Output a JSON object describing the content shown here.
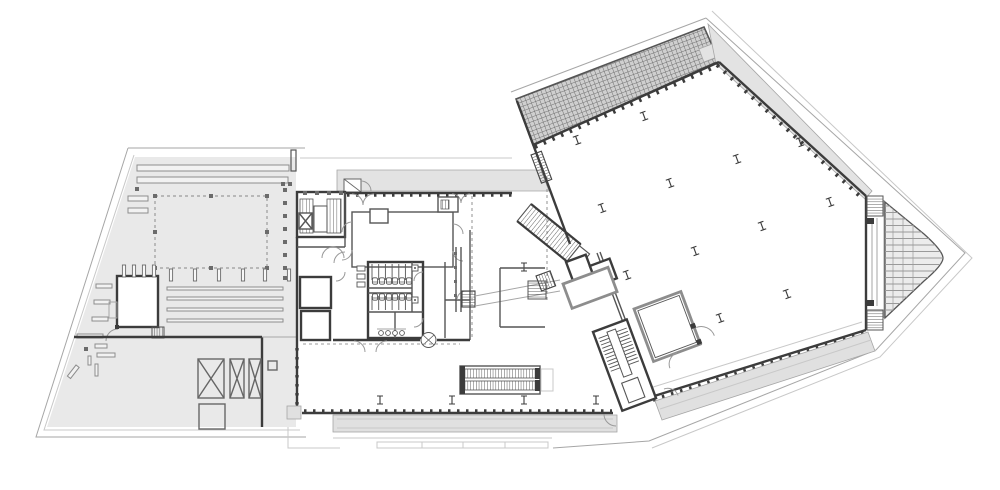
{
  "document": {
    "type": "architectural floor plan, roof / upper level, monochrome line drawing",
    "visible_text": ""
  },
  "palette": {
    "bg": "#ffffff",
    "site": "#e9e9e9",
    "terrace": "#e3e3e3",
    "band": "#e0e0e0",
    "gridband": "#cfcfcf",
    "gridline": "#6e6e6e",
    "deck": "#ececec",
    "deckline": "#9a9a9a",
    "wall": "#3c3c3c",
    "wallmid": "#6b6b6b",
    "wallsoft": "#8d8d8d",
    "line": "#a6a6a6",
    "faint": "#c8c8c8",
    "hatch": "#4a4a4a",
    "dash": "#9b9b9b",
    "barfill": "#f2f2f2"
  },
  "left_wing": {
    "label": "west service terrace (trapezoid, grey)",
    "parking_ticks": [
      [
        171,
        275
      ],
      [
        195,
        275
      ],
      [
        219,
        275
      ],
      [
        243,
        275
      ],
      [
        265,
        275
      ],
      [
        289,
        275
      ]
    ],
    "edge_squares": [
      [
        285,
        190
      ],
      [
        285,
        203
      ],
      [
        285,
        216
      ],
      [
        285,
        229
      ],
      [
        285,
        242
      ],
      [
        285,
        255
      ],
      [
        285,
        268
      ],
      [
        285,
        278
      ],
      [
        137,
        189
      ],
      [
        283,
        184
      ],
      [
        290,
        184
      ]
    ],
    "dashed_nodes": [
      [
        155,
        196
      ],
      [
        211,
        196
      ],
      [
        267,
        196
      ],
      [
        155,
        232
      ],
      [
        267,
        232
      ],
      [
        155,
        268
      ],
      [
        211,
        268
      ],
      [
        267,
        268
      ]
    ],
    "room_posts": [
      [
        124,
        271
      ],
      [
        134,
        271
      ],
      [
        144,
        271
      ],
      [
        154,
        271
      ]
    ],
    "shaft_boxes_with_x": 3
  },
  "middle_building": {
    "label": "central entrance block with cores, WCs and escalator",
    "stair_posts": [
      [
        305,
        193
      ],
      [
        317,
        193
      ],
      [
        329,
        193
      ],
      [
        341,
        193
      ]
    ],
    "column_markers": [
      [
        380,
        400
      ],
      [
        452,
        400
      ],
      [
        524,
        400
      ],
      [
        596,
        400
      ],
      [
        524,
        267
      ]
    ],
    "wc": {
      "fixtures_top": [
        [
          375,
          281
        ],
        [
          382,
          281
        ],
        [
          389,
          281
        ],
        [
          395,
          281
        ],
        [
          402,
          281
        ],
        [
          409,
          281
        ]
      ],
      "fixtures_bottom": [
        [
          375,
          297
        ],
        [
          382,
          297
        ],
        [
          389,
          297
        ],
        [
          395,
          297
        ],
        [
          402,
          297
        ],
        [
          409,
          297
        ]
      ],
      "sinks": [
        [
          381,
          333
        ],
        [
          388,
          333
        ],
        [
          395,
          333
        ],
        [
          402,
          333
        ]
      ],
      "urinals": [
        [
          415,
          268
        ],
        [
          415,
          300
        ]
      ]
    },
    "escalators": 2
  },
  "right_hall": {
    "label": "rotated exhibition hall with skylight grid band and perimeter terrace",
    "rotation_deg": -20.4,
    "column_markers": [
      [
        577,
        140
      ],
      [
        644,
        116
      ],
      [
        602,
        208
      ],
      [
        670,
        183
      ],
      [
        737,
        159
      ],
      [
        800,
        142
      ],
      [
        627,
        275
      ],
      [
        695,
        251
      ],
      [
        762,
        226
      ],
      [
        830,
        202
      ],
      [
        652,
        343
      ],
      [
        720,
        318
      ],
      [
        787,
        294
      ]
    ]
  }
}
